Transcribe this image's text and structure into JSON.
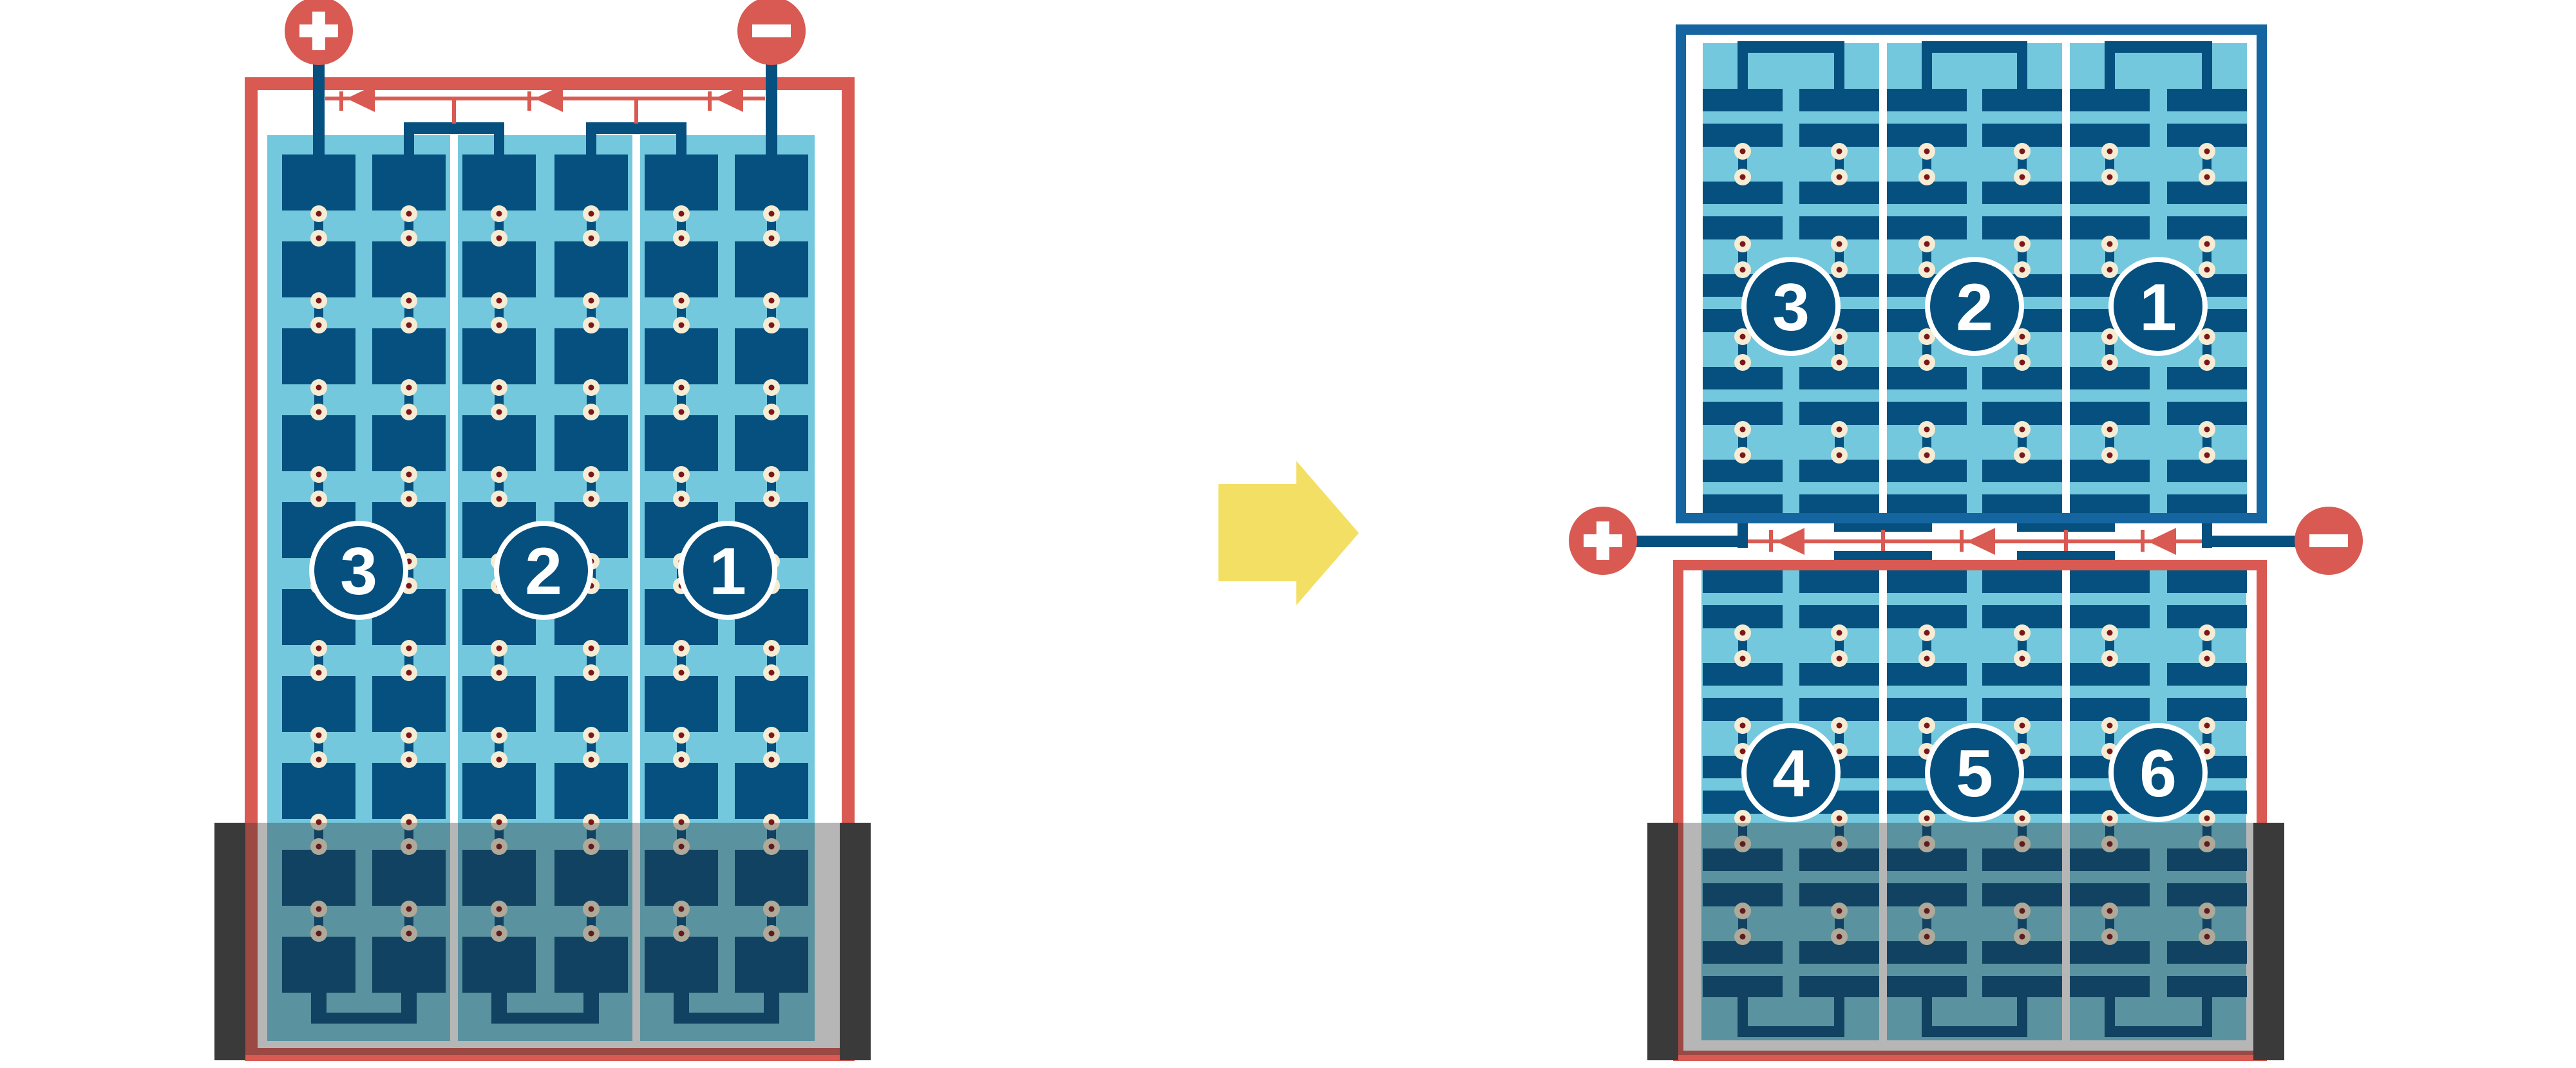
{
  "modules": {
    "left": {
      "terminals": {
        "positive": "+",
        "negative": "−"
      },
      "strings": [
        {
          "label": "3"
        },
        {
          "label": "2"
        },
        {
          "label": "1"
        }
      ]
    },
    "right": {
      "terminals": {
        "positive": "+",
        "negative": "−"
      },
      "top_strings": [
        {
          "label": "3"
        },
        {
          "label": "2"
        },
        {
          "label": "1"
        }
      ],
      "bottom_strings": [
        {
          "label": "4"
        },
        {
          "label": "5"
        },
        {
          "label": "6"
        }
      ]
    }
  },
  "colors": {
    "cell_navy": "#05507e",
    "module_border_blue": "#1565a0",
    "panel_light_blue": "#74c8dd",
    "wire_red": "#d85a52",
    "solder_dot_ring": "#f6ecd4",
    "solder_dot_center": "#7c1618",
    "arrow_yellow": "#f3df63",
    "shade_dark": "#3a3a3a"
  }
}
